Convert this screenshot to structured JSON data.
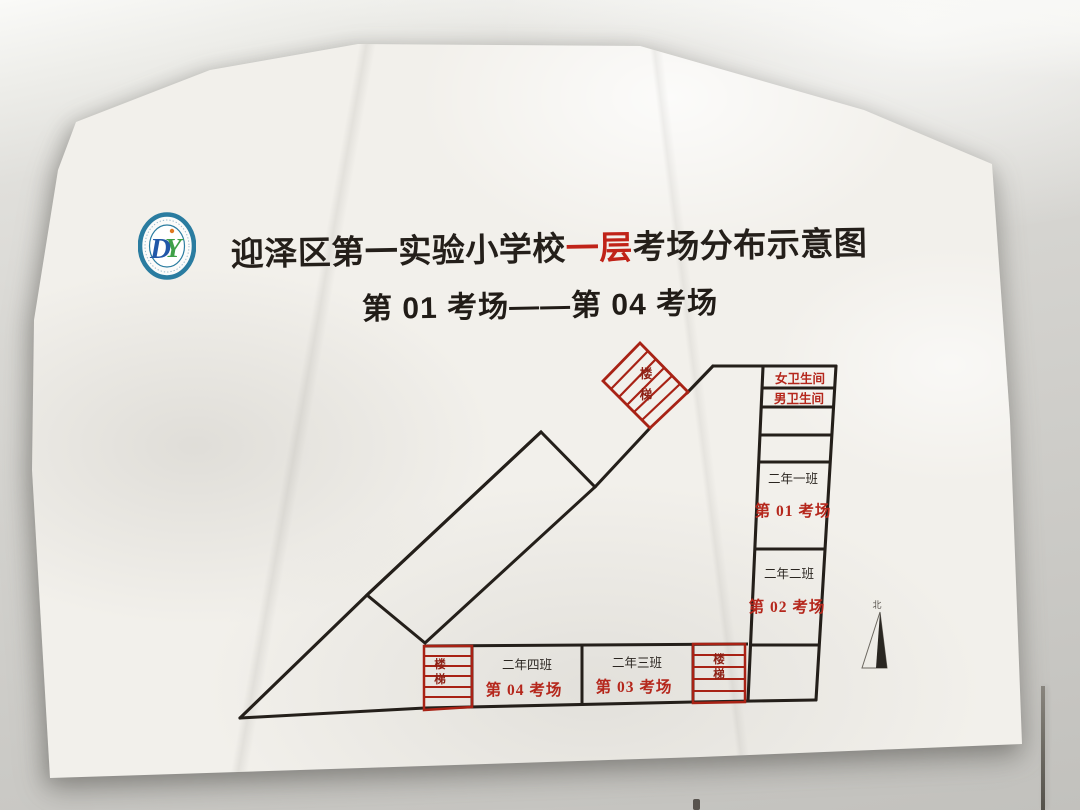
{
  "scene": {
    "wall_base_color": "#d8d7d3",
    "paper_color": "#f2f0eb"
  },
  "poster": {
    "logo": {
      "monogram_d": "D",
      "monogram_y": "Y",
      "ring_color": "#2a7ca0",
      "d_color": "#2157a8",
      "y_color": "#3fa047",
      "accent_color": "#e07820"
    },
    "title": {
      "prefix": "迎泽区第一实验小学校",
      "highlight": "一层",
      "suffix": "考场分布示意图",
      "highlight_color": "#c02318"
    },
    "subtitle": "第 01 考场——第 04 考场",
    "map": {
      "line_color": "#241f1a",
      "stairs_red": "#a82215",
      "red_text_color": "#b5271c",
      "facilities": {
        "stairs": "楼梯",
        "female_wc": "女卫生间",
        "male_wc": "男卫生间",
        "north": "北"
      },
      "rooms": [
        {
          "class_name": "二年一班",
          "exam_name": "第 01 考场"
        },
        {
          "class_name": "二年二班",
          "exam_name": "第 02 考场"
        },
        {
          "class_name": "二年三班",
          "exam_name": "第 03 考场"
        },
        {
          "class_name": "二年四班",
          "exam_name": "第 04 考场"
        }
      ]
    }
  }
}
